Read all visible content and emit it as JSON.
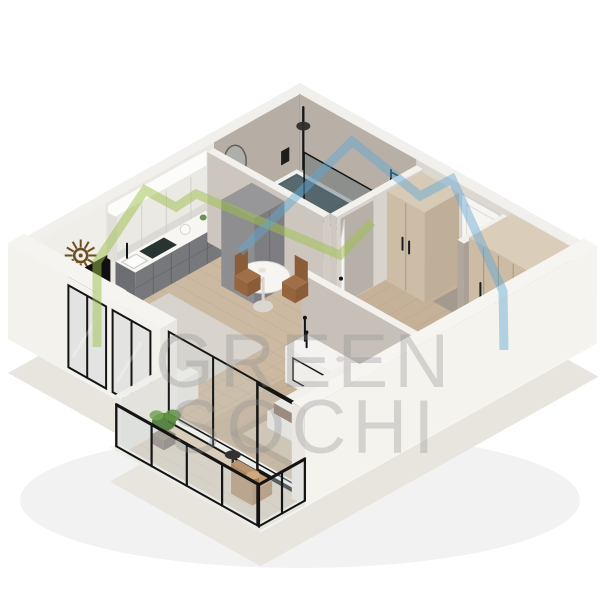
{
  "watermark": {
    "line1": "GREEN",
    "line2": "SOCHI",
    "text_color": "#8f8f8f"
  },
  "logo": {
    "green_color": "#9dbf4b",
    "blue_color": "#5fa8d4",
    "shape": "two-overlapping-mountain-outlines"
  },
  "palette": {
    "background": "#ffffff",
    "plinth_white": "#f6f5f1",
    "wall_greige": "#b6ada4",
    "wall_light": "#dcd7d1",
    "wood_floor": "#cbb9a1",
    "kitchen_cabinet_grey": "#6d6e71",
    "wardrobe_beige": "#ccbba5",
    "bedding_taupe": "#a18876",
    "fixture_black": "#161616",
    "plant_green": "#4e7d38",
    "chair_tan": "#c29b72"
  },
  "scene": {
    "type": "isometric-3d-floor-plan",
    "description": "3D cutaway render of a one-bedroom apartment viewed from above",
    "rooms": [
      "living-room-with-kitchen",
      "bathroom",
      "hallway",
      "bedroom",
      "balcony"
    ],
    "objects": [
      "kitchen-cabinets",
      "cooktop",
      "kitchen-sink",
      "kettle",
      "tall-cabinet",
      "wall-tv",
      "sunburst-wall-decor",
      "dining-table",
      "dining-chairs",
      "sofa",
      "area-rugs",
      "bathtub",
      "black-shower",
      "glass-shower-screen",
      "washbasin",
      "arch-mirror",
      "toilet",
      "towel-radiator",
      "hallway-wardrobe",
      "entry-door",
      "bathroom-door",
      "mirror-partition",
      "bedroom-wardrobe",
      "dresser-with-candlesticks",
      "double-bed",
      "pillows",
      "nightstands",
      "sphere-lamps",
      "balcony-glazing",
      "glass-railing",
      "potted-plant",
      "armchair",
      "side-table"
    ]
  }
}
